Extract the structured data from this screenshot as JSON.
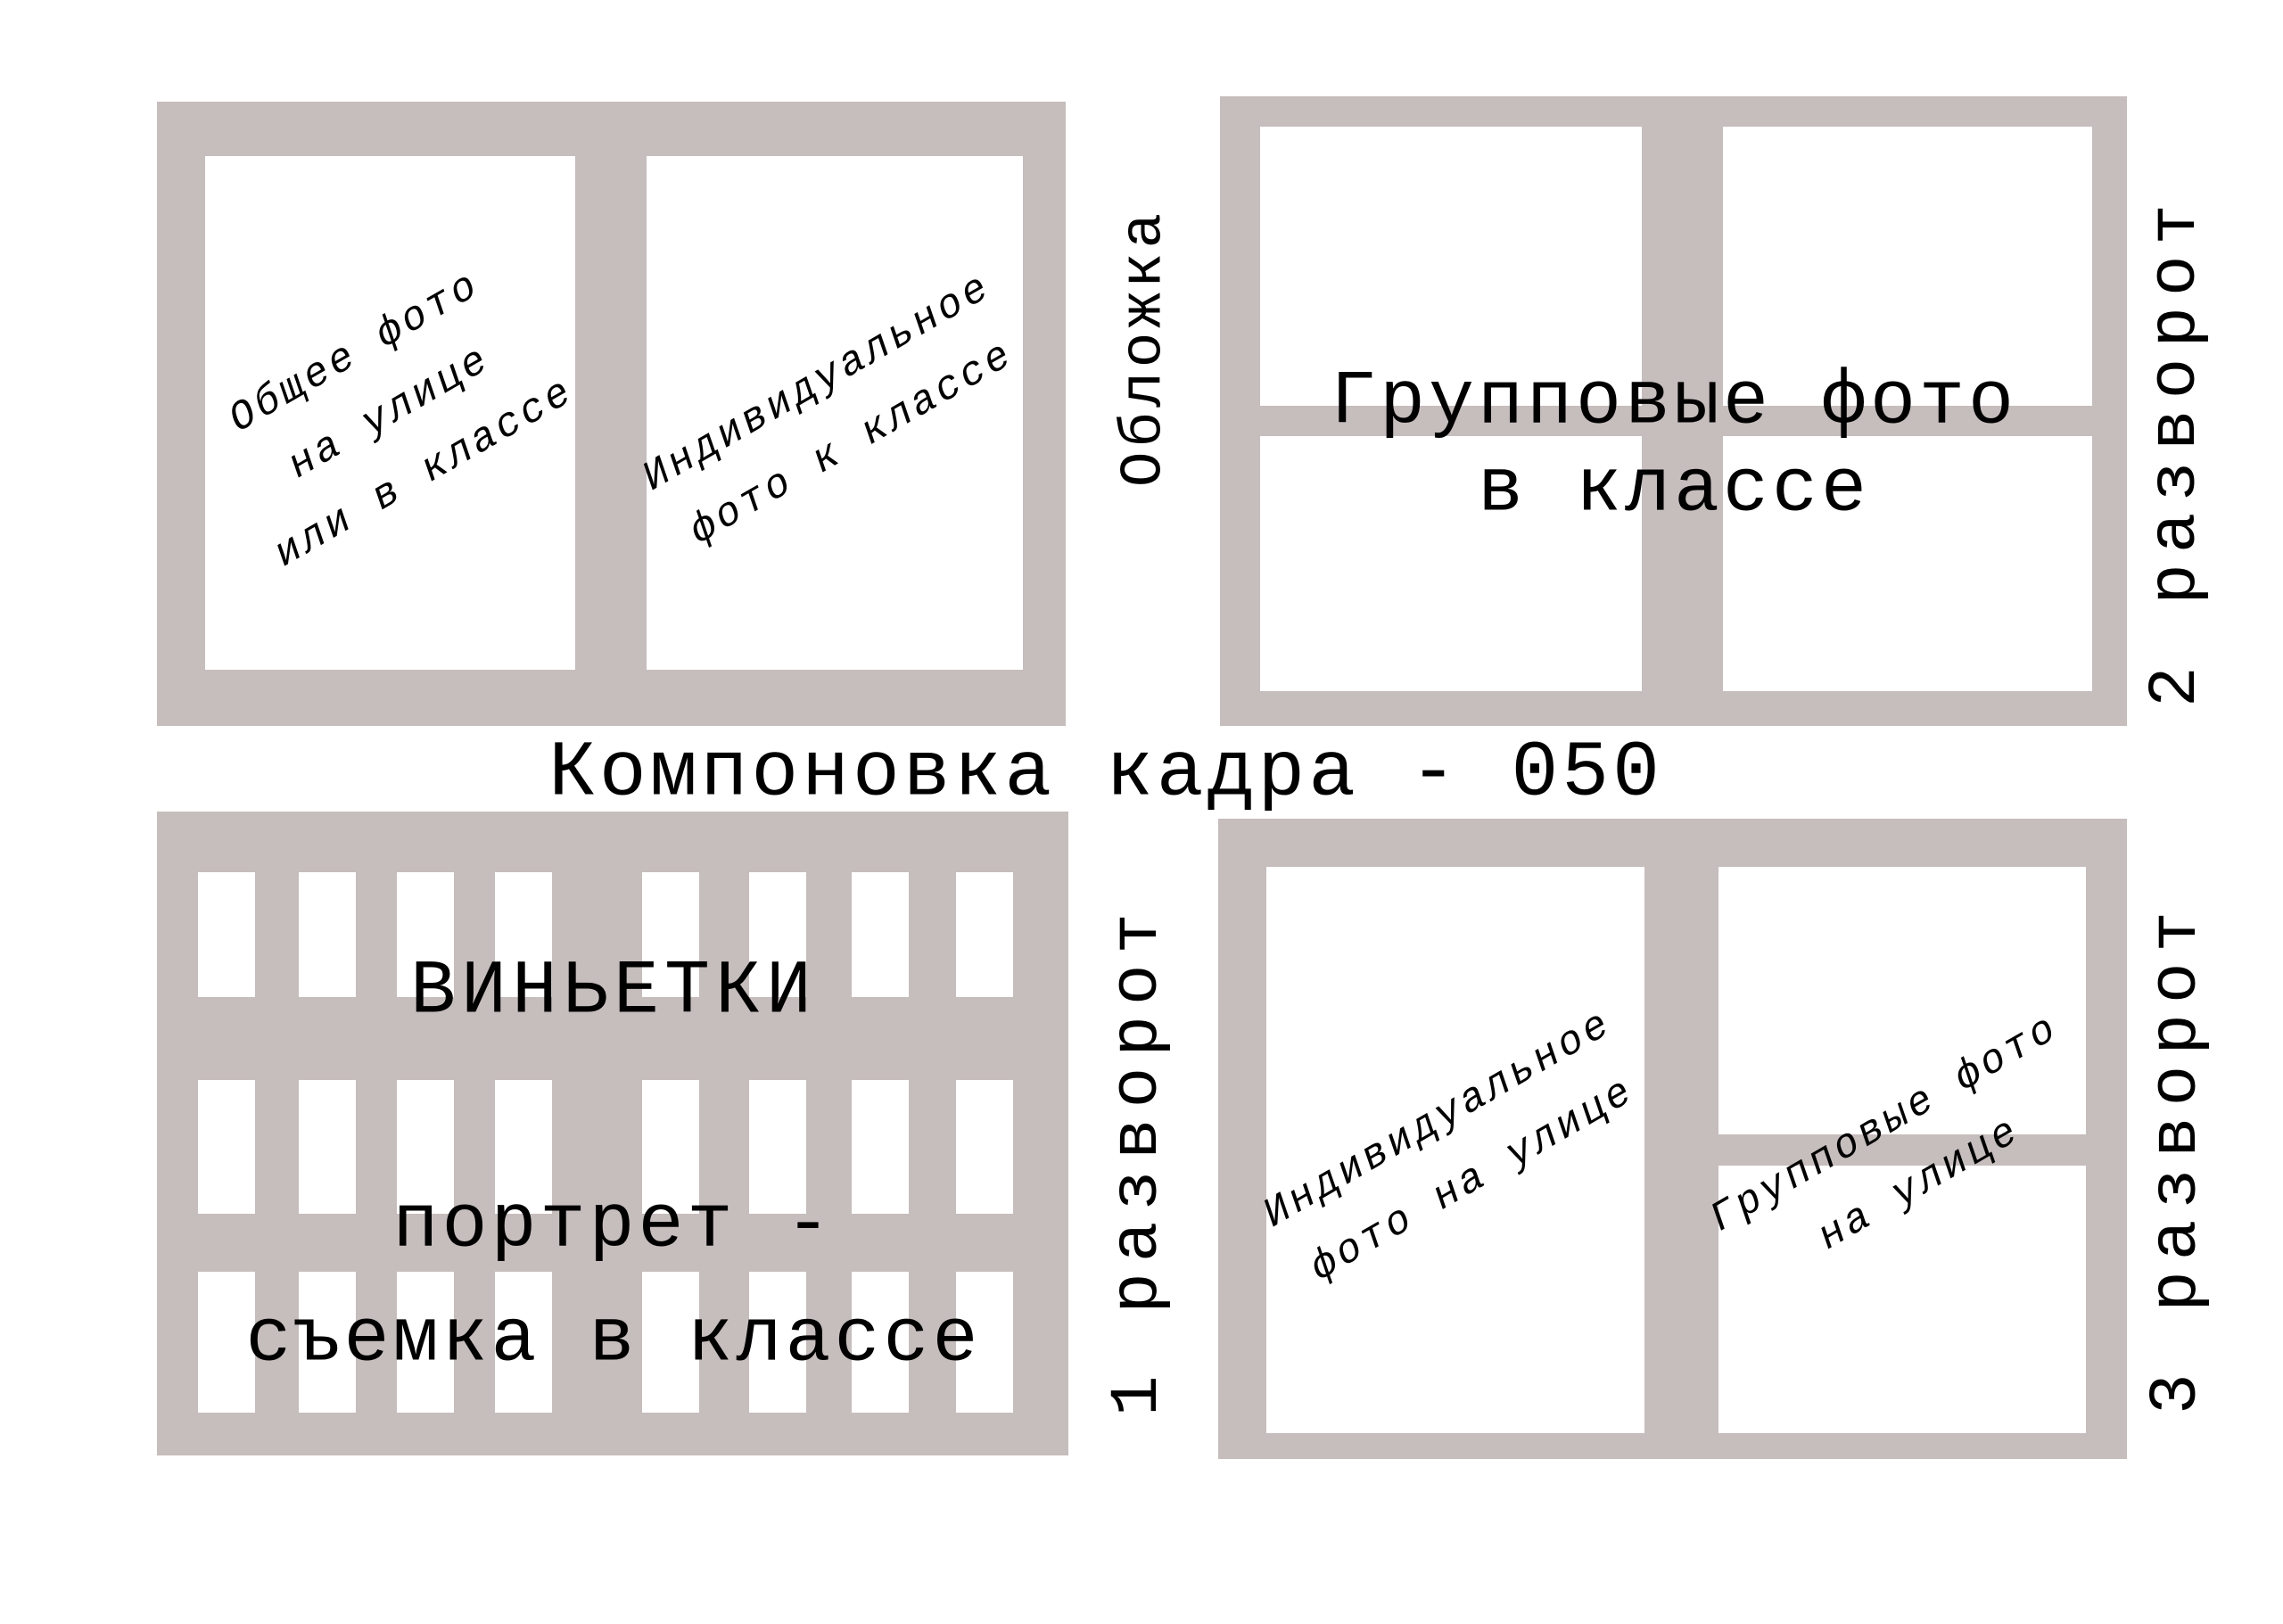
{
  "title": "Компоновка кадра - 050",
  "colors": {
    "panel_gray": "#c6bdbd",
    "ink": "#000000",
    "paper": "#ffffff"
  },
  "cover": {
    "label": "Обложка",
    "left_photo_note": [
      "Общее фото",
      "на улице",
      "или в классе"
    ],
    "right_photo_note": [
      "Индивидуальное",
      "фото к классе"
    ]
  },
  "spread2": {
    "label": "2 разворот",
    "caption": [
      "Групповые фото",
      "в классе"
    ]
  },
  "spread1": {
    "label": "1 разворот",
    "heading": "ВИНЬЕТКИ",
    "caption": [
      "портрет -",
      "съемка в классе"
    ],
    "vignette_rows": 3,
    "vignette_cols": 8
  },
  "spread3": {
    "label": "3 разворот",
    "left_photo_note": [
      "Индивидуальное",
      "фото на улице"
    ],
    "right_photo_note": [
      "Групповые фото",
      "на улице"
    ]
  }
}
